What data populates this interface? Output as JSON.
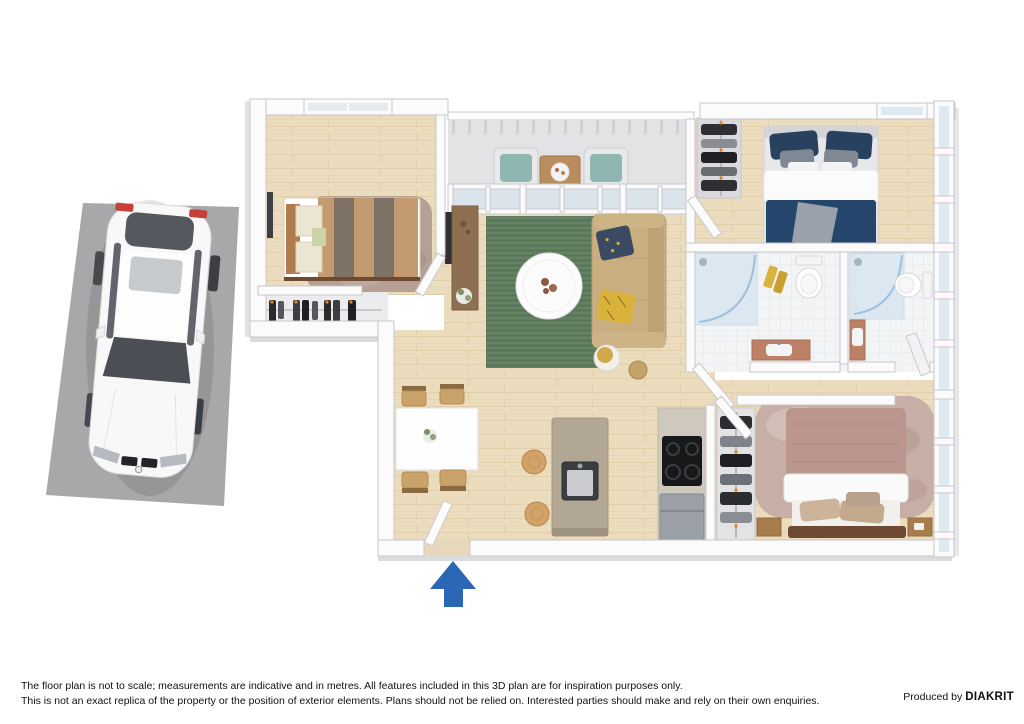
{
  "image": {
    "type": "3d-floor-plan-render",
    "background": "#ffffff"
  },
  "footer": {
    "disclaimer_line1": "The floor plan is not to scale; measurements are indicative and in metres. All features included in this 3D plan are for inspiration purposes only.",
    "disclaimer_line2": "This is not an exact replica of the property or the position of exterior elements. Plans should not be relied on. Interested parties should make and rely on their own enquiries.",
    "produced_by_prefix": "Produced by",
    "producer_brand": "DIAKRIT"
  },
  "icons": {
    "entry_arrow": "filled-up-arrow"
  },
  "colors": {
    "entry_arrow_blue": "#2b67b4",
    "parking_pad_gray": "#a8a8ab",
    "wood_floor": "#ecdcbe",
    "living_rug_green": "#5e7b60",
    "sofa_tan": "#c8ae80",
    "bed1_duvet_tan": "#c49a71",
    "bed1_duvet_stripe": "#7e7264",
    "bed2_duvet_navy": "#24456c",
    "bed3_duvet_mauve": "#bb968c",
    "bathroom_glass_blue": "#d7e6f2",
    "vanity_terracotta": "#bd8168",
    "wall_white": "#fbfbfc"
  }
}
